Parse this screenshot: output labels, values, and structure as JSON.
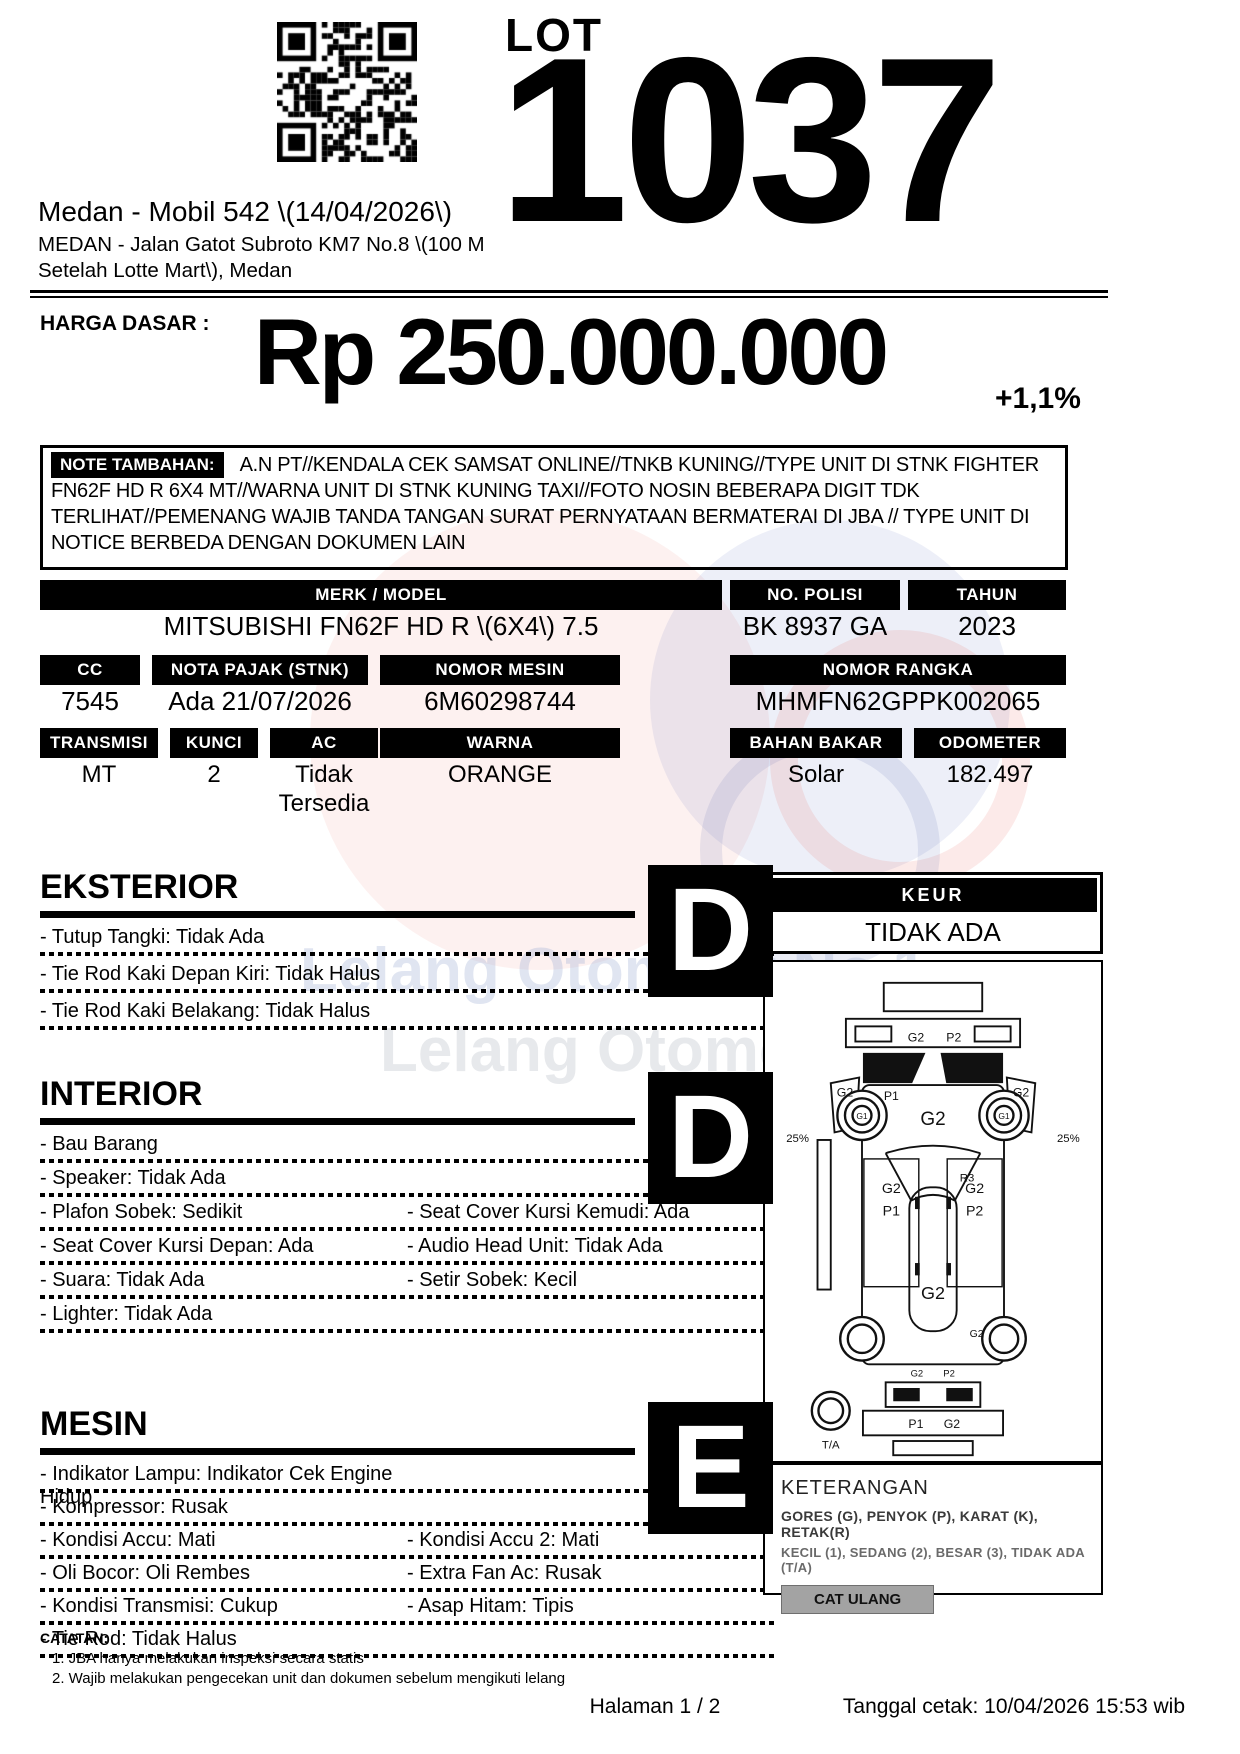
{
  "lot": {
    "label": "LOT",
    "number": "1037"
  },
  "header": {
    "title": "Medan - Mobil 542 \\(14/04/2026\\)",
    "address_line1": "MEDAN - Jalan Gatot Subroto KM7 No.8 \\(100 M",
    "address_line2": "Setelah Lotte Mart\\), Medan"
  },
  "price": {
    "label": "HARGA DASAR :",
    "value": "Rp 250.000.000",
    "change": "+1,1%"
  },
  "note": {
    "label": "NOTE TAMBAHAN:",
    "text": "A.N PT//KENDALA CEK SAMSAT ONLINE//TNKB KUNING//TYPE UNIT DI STNK FIGHTER FN62F HD R 6X4 MT//WARNA UNIT DI STNK KUNING TAXI//FOTO NOSIN BEBERAPA DIGIT TDK TERLIHAT//PEMENANG WAJIB TANDA TANGAN SURAT PERNYATAAN BERMATERAI DI JBA // TYPE UNIT DI NOTICE BERBEDA DENGAN DOKUMEN LAIN"
  },
  "specs": {
    "row1": {
      "headers": [
        "MERK / MODEL",
        "NO. POLISI",
        "TAHUN"
      ],
      "values": [
        "MITSUBISHI FN62F HD R \\(6X4\\) 7.5",
        "BK 8937 GA",
        "2023"
      ]
    },
    "row2": {
      "headers": [
        "CC",
        "NOTA PAJAK (STNK)",
        "NOMOR MESIN",
        "NOMOR RANGKA"
      ],
      "values": [
        "7545",
        "Ada 21/07/2026",
        "6M60298744",
        "MHMFN62GPPK002065"
      ]
    },
    "row3": {
      "headers": [
        "TRANSMISI",
        "KUNCI",
        "AC",
        "WARNA",
        "BAHAN BAKAR",
        "ODOMETER"
      ],
      "values": [
        "MT",
        "2",
        "Tidak Tersedia",
        "ORANGE",
        "Solar",
        "182.497"
      ]
    }
  },
  "sections": {
    "eksterior": {
      "title": "EKSTERIOR",
      "grade": "D",
      "items": [
        {
          "l": "- Tutup Tangki: Tidak Ada",
          "r": ""
        },
        {
          "l": "- Tie Rod Kaki Depan Kiri: Tidak Halus",
          "r": ""
        },
        {
          "l": "- Tie Rod Kaki Belakang: Tidak Halus",
          "r": ""
        }
      ]
    },
    "interior": {
      "title": "INTERIOR",
      "grade": "D",
      "items": [
        {
          "l": "- Bau Barang",
          "r": ""
        },
        {
          "l": "- Speaker: Tidak Ada",
          "r": ""
        },
        {
          "l": "- Plafon Sobek: Sedikit",
          "r": "- Seat Cover Kursi Kemudi: Ada"
        },
        {
          "l": "- Seat Cover Kursi Depan: Ada",
          "r": "- Audio Head Unit: Tidak Ada"
        },
        {
          "l": "- Suara: Tidak Ada",
          "r": "- Setir Sobek: Kecil"
        },
        {
          "l": "- Lighter: Tidak Ada",
          "r": ""
        }
      ]
    },
    "mesin": {
      "title": "MESIN",
      "grade": "E",
      "items": [
        {
          "l": "- Indikator Lampu: Indikator Cek Engine Hidup",
          "r": ""
        },
        {
          "l": "- Kompressor: Rusak",
          "r": ""
        },
        {
          "l": "- Kondisi Accu: Mati",
          "r": "- Kondisi Accu 2: Mati"
        },
        {
          "l": "- Oli Bocor: Oli Rembes",
          "r": "- Extra Fan Ac: Rusak"
        },
        {
          "l": "- Kondisi Transmisi: Cukup",
          "r": "- Asap Hitam: Tipis"
        },
        {
          "l": "- Tie Rod: Tidak Halus",
          "r": ""
        }
      ]
    }
  },
  "keur": {
    "label": "KEUR",
    "value": "TIDAK ADA"
  },
  "diagram": {
    "labels": [
      {
        "t": "G2",
        "x": 152,
        "y": 84,
        "s": 13
      },
      {
        "t": "P2",
        "x": 192,
        "y": 84,
        "s": 13
      },
      {
        "t": "G2",
        "x": 77,
        "y": 142,
        "s": 13
      },
      {
        "t": "G2",
        "x": 263,
        "y": 142,
        "s": 13
      },
      {
        "t": "G2",
        "x": 170,
        "y": 172,
        "s": 20
      },
      {
        "t": "G1",
        "x": 95,
        "y": 166,
        "s": 9
      },
      {
        "t": "G1",
        "x": 245,
        "y": 166,
        "s": 9
      },
      {
        "t": "P1",
        "x": 126,
        "y": 146,
        "s": 13
      },
      {
        "t": "25%",
        "x": 27,
        "y": 190,
        "s": 12
      },
      {
        "t": "25%",
        "x": 313,
        "y": 190,
        "s": 12
      },
      {
        "t": "R3",
        "x": 206,
        "y": 232,
        "s": 12
      },
      {
        "t": "G2",
        "x": 126,
        "y": 244,
        "s": 15
      },
      {
        "t": "P1",
        "x": 126,
        "y": 268,
        "s": 15
      },
      {
        "t": "G2",
        "x": 214,
        "y": 244,
        "s": 15
      },
      {
        "t": "P2",
        "x": 214,
        "y": 268,
        "s": 15
      },
      {
        "t": "G2",
        "x": 170,
        "y": 356,
        "s": 19
      },
      {
        "t": "G2",
        "x": 216,
        "y": 396,
        "s": 11
      },
      {
        "t": "G2",
        "x": 153,
        "y": 438,
        "s": 10
      },
      {
        "t": "P2",
        "x": 187,
        "y": 438,
        "s": 10
      },
      {
        "t": "P1",
        "x": 152,
        "y": 492,
        "s": 13
      },
      {
        "t": "G2",
        "x": 190,
        "y": 492,
        "s": 13
      },
      {
        "t": "T/A",
        "x": 62,
        "y": 514,
        "s": 12
      }
    ]
  },
  "keterangan": {
    "title": "KETERANGAN",
    "line1": "GORES (G), PENYOK (P), KARAT (K), RETAK(R)",
    "line2": "KECIL (1), SEDANG (2), BESAR (3), TIDAK ADA (T/A)",
    "button": "CAT ULANG"
  },
  "footer": {
    "catatan": "CATATAN:",
    "note1": "1. JBA hanya melakukan inspeksi secara statis",
    "note2": "2. Wajib melakukan pengecekan unit dan dokumen sebelum mengikuti lelang",
    "page": "Halaman 1 / 2",
    "printed": "Tanggal cetak: 10/04/2026 15:53 wib"
  },
  "watermark": {
    "line1": "Lelang Otomotif No.1",
    "line2": "Lelang Otomotif"
  },
  "colors": {
    "button_gray": "#a3a3a3",
    "ink": "#000000"
  }
}
